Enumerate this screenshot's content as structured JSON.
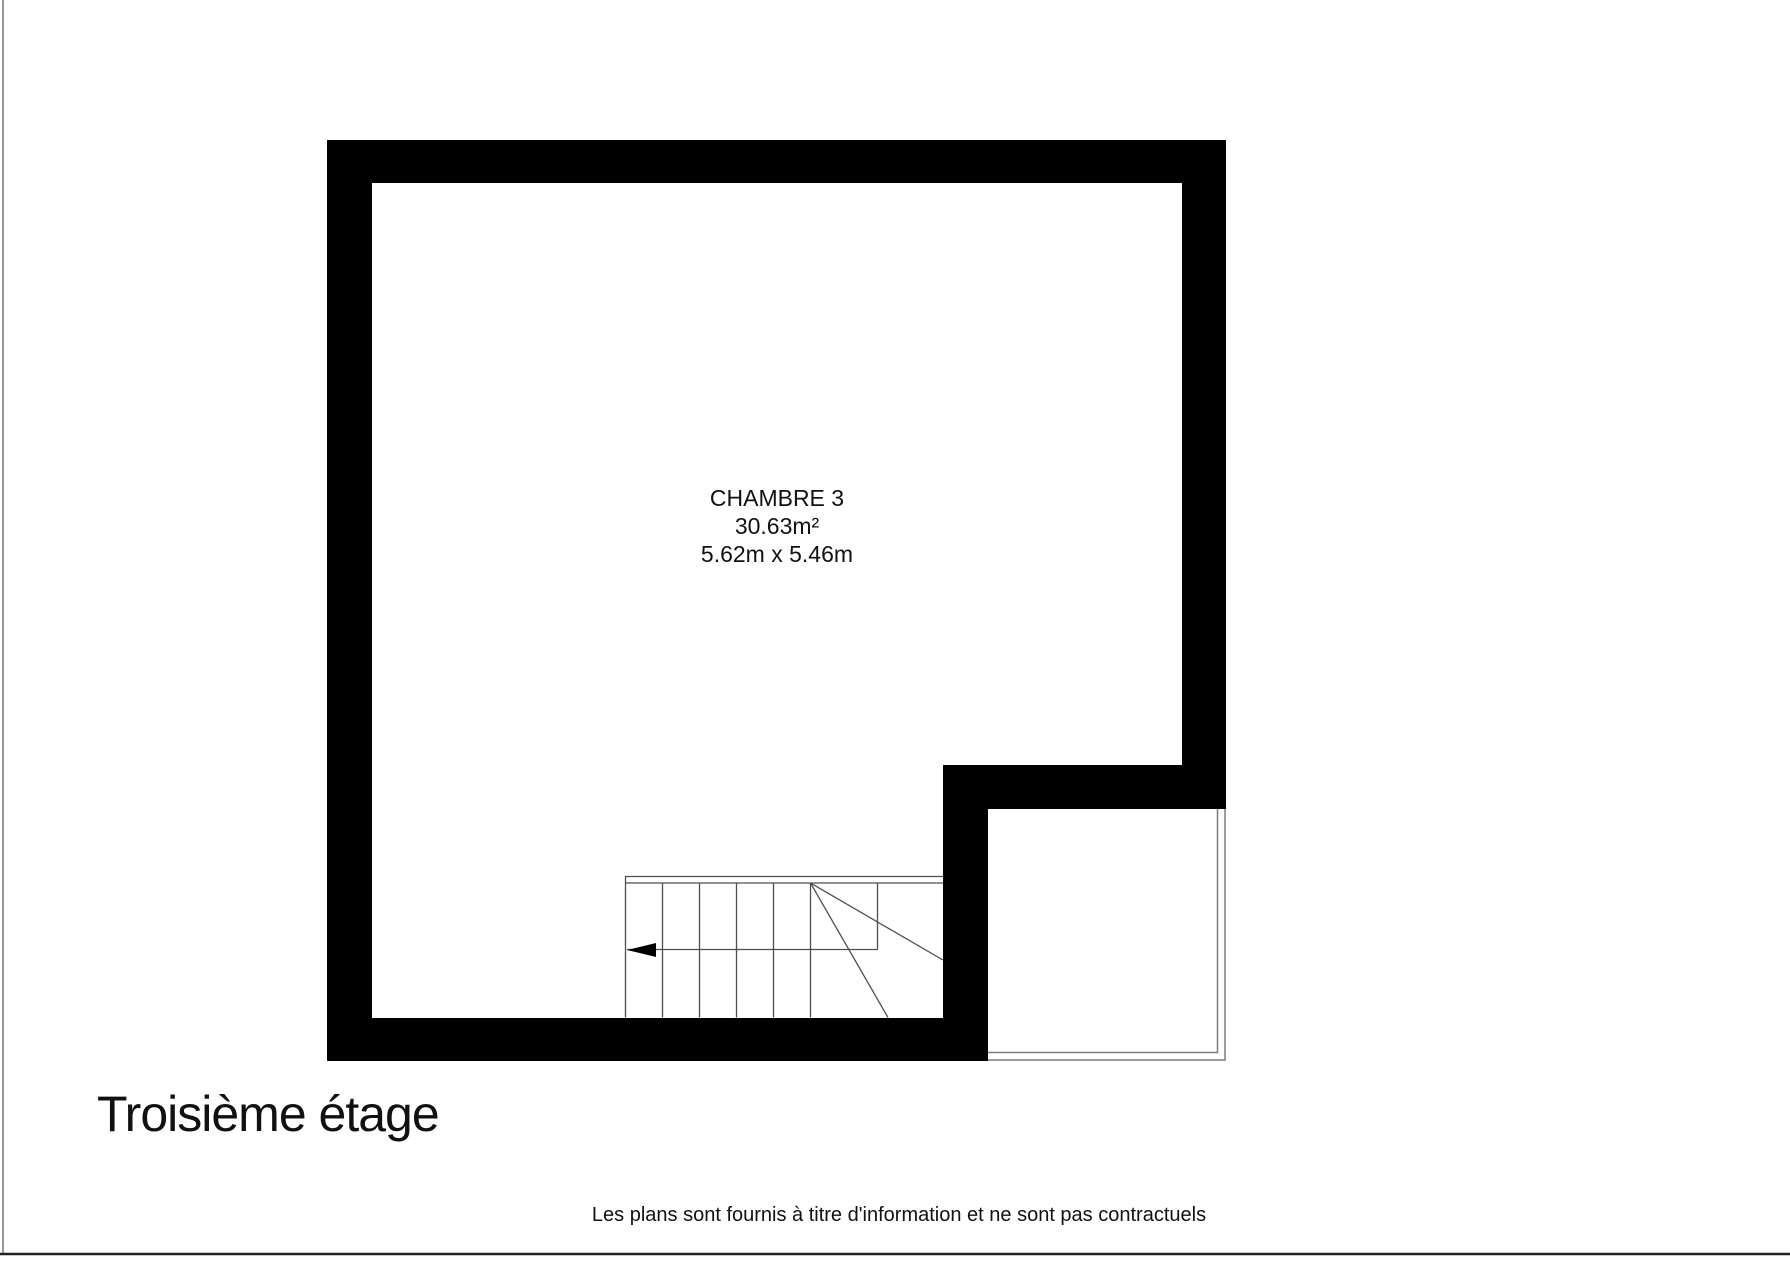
{
  "page": {
    "floor_title": "Troisième étage",
    "disclaimer": "Les plans sont fournis à titre d'information et ne sont pas contractuels"
  },
  "room": {
    "name": "CHAMBRE 3",
    "area": "30.63m²",
    "dimensions": "5.62m x 5.46m"
  },
  "colors": {
    "wall": "#000000",
    "thin_outline": "#7d7d7d",
    "stair_line": "#4f4f4f",
    "arrow": "#000000",
    "page_border_left": "#8a8a8a",
    "page_border_bottom": "#222222",
    "text": "#111111"
  }
}
